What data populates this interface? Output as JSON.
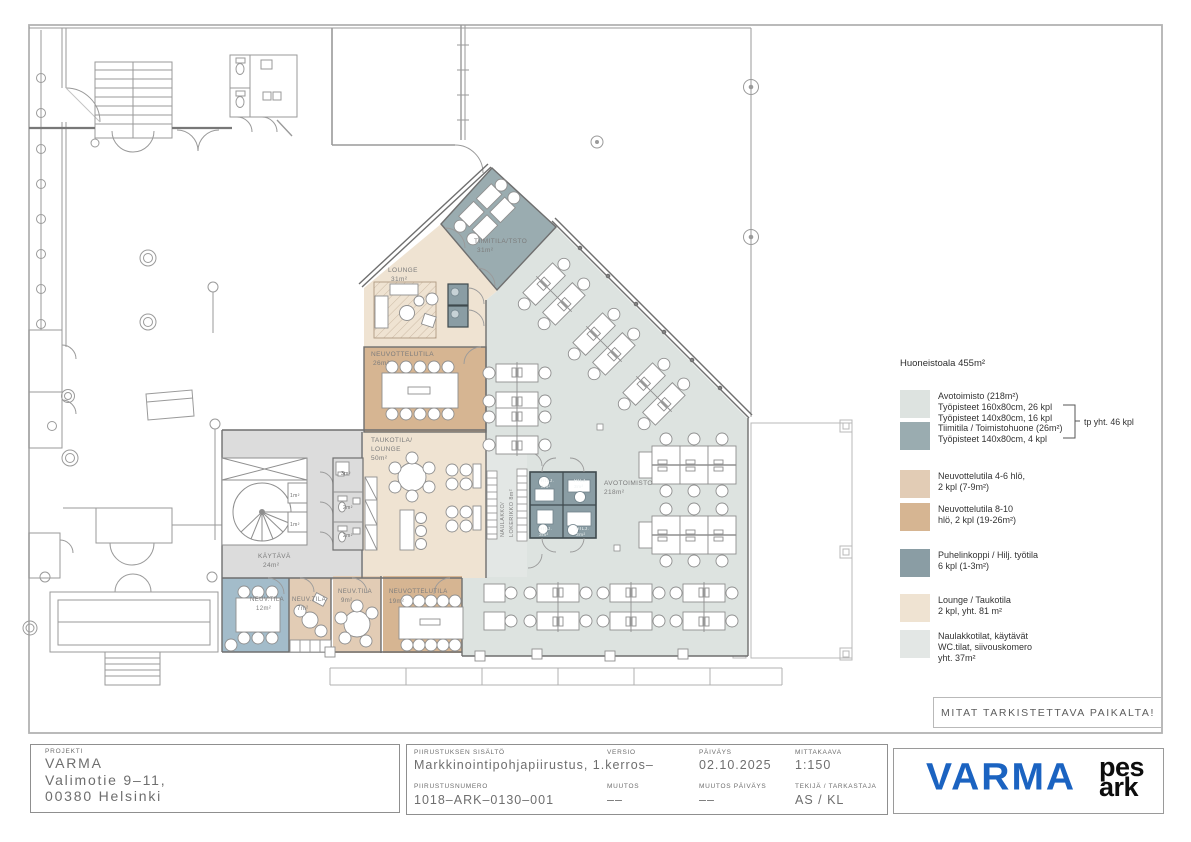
{
  "palette": {
    "avotoimisto": "#dde3e0",
    "tiimitila": "#9aacb0",
    "neuv_small": "#e2ccb5",
    "neuv_large": "#d6b592",
    "puhelinkoppi": "#8a9da4",
    "lounge": "#efe3d2",
    "naulakko": "#e3e7e5",
    "corridor": "#dcdcdc",
    "blue_room": "#a3bcca",
    "varma_blue": "#1b63c1"
  },
  "legend": {
    "title": "Huoneistoala 455m²",
    "bracket_label": "tp yht. 46 kpl",
    "items": [
      {
        "color": "avotoimisto",
        "lines": [
          "Avotoimisto (218m²)",
          "Työpisteet 160x80cm, 26 kpl",
          "Työpisteet 140x80cm, 16 kpl"
        ]
      },
      {
        "color": "tiimitila",
        "lines": [
          "Tiimitila / Toimistohuone (26m²)",
          "Työpisteet 140x80cm, 4 kpl"
        ]
      },
      {
        "color": "neuv_small",
        "lines": [
          "Neuvottelutila 4-6 hlö,",
          "2 kpl (7-9m²)"
        ]
      },
      {
        "color": "neuv_large",
        "lines": [
          "Neuvottelutila 8-10",
          "hlö, 2 kpl (19-26m²)"
        ]
      },
      {
        "color": "puhelinkoppi",
        "lines": [
          "Puhelinkoppi / Hilj. työtila",
          "6 kpl (1-3m²)"
        ]
      },
      {
        "color": "lounge",
        "lines": [
          "Lounge / Taukotila",
          "2 kpl, yht. 81 m²"
        ]
      },
      {
        "color": "naulakko",
        "lines": [
          "Naulakkotilat, käytävät",
          "WC.tilat, siivouskomero",
          "yht. 37m²"
        ]
      }
    ]
  },
  "plan": {
    "labels": {
      "lounge_name": "LOUNGE",
      "lounge_area": "31m²",
      "tiimitila_name": "TIIMITILA/TSTO",
      "tiimitila_area": "31m²",
      "neuv26_name": "NEUVOTTELUTILA",
      "neuv26_area": "26m²",
      "tauko_l1": "TAUKOTILA/",
      "tauko_l2": "LOUNGE",
      "tauko_area": "50m²",
      "kaytava_name": "KÄYTÄVÄ",
      "kaytava_area": "24m²",
      "naulakko_l1": "NAULAKKO/",
      "naulakko_l2": "LOKERIKKO 8m²",
      "avotoimisto_name": "AVOTOIMISTO",
      "avotoimisto_area": "218m²",
      "hilj": "HILJ.",
      "hilj_area": "3m²",
      "neuv12_name": "NEUV.TILA",
      "neuv12_area": "12m²",
      "neuv7_name": "NEUV.TILA",
      "neuv7_area": "7m²",
      "neuv9_name": "NEUV.TILA",
      "neuv9_area": "9m²",
      "neuv19_name": "NEUVOTTELUTILA",
      "neuv19_area": "19m²",
      "wc3": "3m²",
      "wc2a": "2m²",
      "wc2b": "2m²",
      "c1a": "1m²",
      "c1b": "1m²"
    }
  },
  "note": "MITAT TARKISTETTAVA PAIKALTA!",
  "titleblock": {
    "project_label": "PROJEKTI",
    "project_name": "VARMA",
    "address_line1": "Valimotie 9–11,",
    "address_line2": "00380 Helsinki",
    "content_label": "PIIRUSTUKSEN SISÄLTÖ",
    "content_value": "Markkinointipohjapiirustus, 1.kerros–",
    "versio_label": "VERSIO",
    "versio_value": "",
    "paivays_label": "PÄIVÄYS",
    "paivays_value": "02.10.2025",
    "mittakaava_label": "MITTAKAAVA",
    "mittakaava_value": "1:150",
    "numero_label": "PIIRUSTUSNUMERO",
    "numero_value": "1018–ARK–0130–001",
    "muutos_label": "MUUTOS",
    "muutos_value": "––",
    "muutos_paivays_label": "MUUTOS PÄIVÄYS",
    "muutos_paivays_value": "––",
    "tekija_label": "TEKIJÄ / TARKASTAJA",
    "tekija_value": "AS / KL"
  },
  "logos": {
    "varma": "VARMA",
    "studio_line1": "pes",
    "studio_line2": "ark"
  }
}
